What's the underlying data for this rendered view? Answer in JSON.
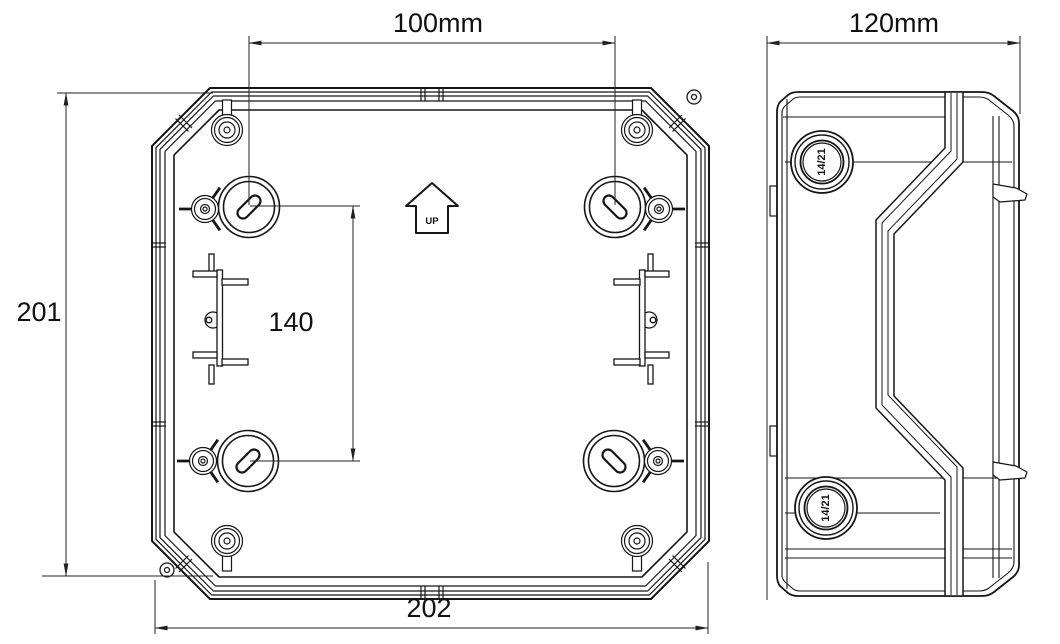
{
  "colors": {
    "background": "#ffffff",
    "line": "#161616",
    "dimension": "#222222"
  },
  "front_view": {
    "up_label": "UP"
  },
  "side_view": {
    "knockout_top_label": "14/21",
    "knockout_bottom_label": "14/21"
  },
  "dimensions": {
    "hole_spacing_width": "100mm",
    "depth": "120mm",
    "height": "201",
    "width": "202",
    "hole_spacing_height": "140"
  }
}
